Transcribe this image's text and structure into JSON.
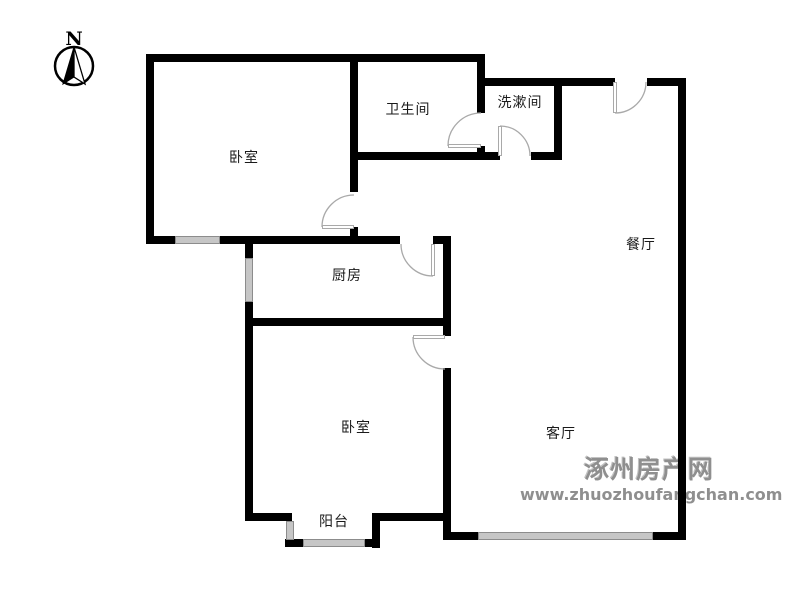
{
  "palette": {
    "wall": "#000000",
    "door_line": "#a9a9a9",
    "door_fill": "#ffffff",
    "window_line": "#8c8c8c",
    "window_fill": "#ffffff",
    "label_color": "#1a1a1a",
    "compass_color": "#000000",
    "watermark_color": "#8f8f8f"
  },
  "compass": {
    "label": "N",
    "cx": 74,
    "cy": 66,
    "r": 19,
    "label_x": 74,
    "label_y": 45,
    "needle_left": "74,47 63,84 74,77",
    "needle_right": "74,47 85,84 74,77"
  },
  "watermark": {
    "line1": "涿州房产网",
    "line2": "www.zhuozhoufangchan.com"
  },
  "rooms": [
    {
      "name": "bedroom-1",
      "label": "卧室",
      "x": 244,
      "y": 158
    },
    {
      "name": "bathroom",
      "label": "卫生间",
      "x": 408,
      "y": 110
    },
    {
      "name": "washroom",
      "label": "洗漱间",
      "x": 520,
      "y": 103
    },
    {
      "name": "dining-room",
      "label": "餐厅",
      "x": 641,
      "y": 245
    },
    {
      "name": "kitchen",
      "label": "厨房",
      "x": 347,
      "y": 276
    },
    {
      "name": "bedroom-2",
      "label": "卧室",
      "x": 356,
      "y": 428
    },
    {
      "name": "living-room",
      "label": "客厅",
      "x": 561,
      "y": 434
    },
    {
      "name": "balcony",
      "label": "阳台",
      "x": 334,
      "y": 522
    }
  ],
  "floorplan": {
    "wall_thickness": 8,
    "walls": [
      {
        "name": "top-main",
        "x": 146,
        "y": 54,
        "w": 339,
        "h": 8
      },
      {
        "name": "top-right-a",
        "x": 477,
        "y": 78,
        "w": 138,
        "h": 8
      },
      {
        "name": "top-right-b",
        "x": 647,
        "y": 78,
        "w": 39,
        "h": 8
      },
      {
        "name": "bath-bottom",
        "x": 350,
        "y": 152,
        "w": 150,
        "h": 8
      },
      {
        "name": "washroom-bottom",
        "x": 531,
        "y": 152,
        "w": 31,
        "h": 8
      },
      {
        "name": "mid-left",
        "x": 146,
        "y": 236,
        "w": 29,
        "h": 8
      },
      {
        "name": "mid-center",
        "x": 220,
        "y": 236,
        "w": 180,
        "h": 8
      },
      {
        "name": "mid-right",
        "x": 433,
        "y": 236,
        "w": 18,
        "h": 8
      },
      {
        "name": "kitchen-bottom",
        "x": 245,
        "y": 318,
        "w": 206,
        "h": 8
      },
      {
        "name": "bed2-bottom-left",
        "x": 245,
        "y": 513,
        "w": 47,
        "h": 8
      },
      {
        "name": "bed2-bottom-right",
        "x": 372,
        "y": 513,
        "w": 79,
        "h": 8
      },
      {
        "name": "living-bottom-left",
        "x": 443,
        "y": 532,
        "w": 35,
        "h": 8
      },
      {
        "name": "living-bottom-right",
        "x": 653,
        "y": 532,
        "w": 33,
        "h": 8
      },
      {
        "name": "balcony-corner-left",
        "x": 285,
        "y": 539,
        "w": 18,
        "h": 8
      },
      {
        "name": "balcony-corner-right",
        "x": 365,
        "y": 539,
        "w": 15,
        "h": 8
      },
      {
        "name": "left-outer",
        "x": 146,
        "y": 54,
        "w": 8,
        "h": 190
      },
      {
        "name": "bed1-right-upper",
        "x": 350,
        "y": 54,
        "w": 8,
        "h": 138
      },
      {
        "name": "bed1-right-lower",
        "x": 350,
        "y": 227,
        "w": 8,
        "h": 17
      },
      {
        "name": "bath-right-upper",
        "x": 477,
        "y": 54,
        "w": 8,
        "h": 59
      },
      {
        "name": "bath-right-lower",
        "x": 477,
        "y": 146,
        "w": 8,
        "h": 14
      },
      {
        "name": "washroom-right",
        "x": 554,
        "y": 78,
        "w": 8,
        "h": 82
      },
      {
        "name": "center-upper",
        "x": 443,
        "y": 244,
        "w": 8,
        "h": 92
      },
      {
        "name": "center-lower",
        "x": 443,
        "y": 368,
        "w": 8,
        "h": 172
      },
      {
        "name": "kitchen-left-upper",
        "x": 245,
        "y": 244,
        "w": 8,
        "h": 14
      },
      {
        "name": "kitchen-left-lower",
        "x": 245,
        "y": 302,
        "w": 8,
        "h": 219
      },
      {
        "name": "balcony-right",
        "x": 372,
        "y": 513,
        "w": 8,
        "h": 35
      },
      {
        "name": "right-outer",
        "x": 678,
        "y": 78,
        "w": 8,
        "h": 462
      }
    ],
    "windows": [
      {
        "name": "bedroom1-window",
        "x": 175,
        "y": 236,
        "w": 45,
        "h": 8,
        "orient": "h"
      },
      {
        "name": "kitchen-left-window",
        "x": 245,
        "y": 258,
        "w": 8,
        "h": 44,
        "orient": "v"
      },
      {
        "name": "balcony-left-window",
        "x": 286,
        "y": 521,
        "w": 8,
        "h": 19,
        "orient": "v"
      },
      {
        "name": "balcony-bottom-window",
        "x": 303,
        "y": 539,
        "w": 62,
        "h": 8,
        "orient": "h"
      },
      {
        "name": "living-bottom-window",
        "x": 478,
        "y": 532,
        "w": 175,
        "h": 8,
        "orient": "h"
      }
    ],
    "doors": [
      {
        "name": "bedroom1-door",
        "hinge": [
          354,
          227
        ],
        "tip": [
          322,
          227
        ],
        "end": [
          354,
          195
        ],
        "r": 32,
        "sweep": 1,
        "leaf": {
          "x": 322,
          "y": 225,
          "w": 32,
          "h": 4
        }
      },
      {
        "name": "bathroom-door",
        "hinge": [
          481,
          146
        ],
        "tip": [
          448,
          146
        ],
        "end": [
          481,
          113
        ],
        "r": 33,
        "sweep": 1,
        "leaf": {
          "x": 448,
          "y": 144,
          "w": 33,
          "h": 4
        }
      },
      {
        "name": "washroom-door",
        "hinge": [
          500,
          156
        ],
        "tip": [
          500,
          126
        ],
        "end": [
          530,
          156
        ],
        "r": 30,
        "sweep": 1,
        "leaf": {
          "x": 498,
          "y": 126,
          "w": 4,
          "h": 30
        }
      },
      {
        "name": "kitchen-door",
        "hinge": [
          433,
          244
        ],
        "tip": [
          433,
          276
        ],
        "end": [
          401,
          244
        ],
        "r": 32,
        "sweep": 1,
        "leaf": {
          "x": 431,
          "y": 244,
          "w": 4,
          "h": 32
        }
      },
      {
        "name": "bedroom2-door",
        "hinge": [
          445,
          337
        ],
        "tip": [
          413,
          337
        ],
        "end": [
          445,
          369
        ],
        "r": 32,
        "sweep": 0,
        "leaf": {
          "x": 413,
          "y": 335,
          "w": 32,
          "h": 4
        }
      },
      {
        "name": "entrance-door",
        "hinge": [
          615,
          82
        ],
        "tip": [
          615,
          113
        ],
        "end": [
          646,
          82
        ],
        "r": 31,
        "sweep": 0,
        "leaf": {
          "x": 613,
          "y": 82,
          "w": 4,
          "h": 31
        }
      }
    ]
  }
}
